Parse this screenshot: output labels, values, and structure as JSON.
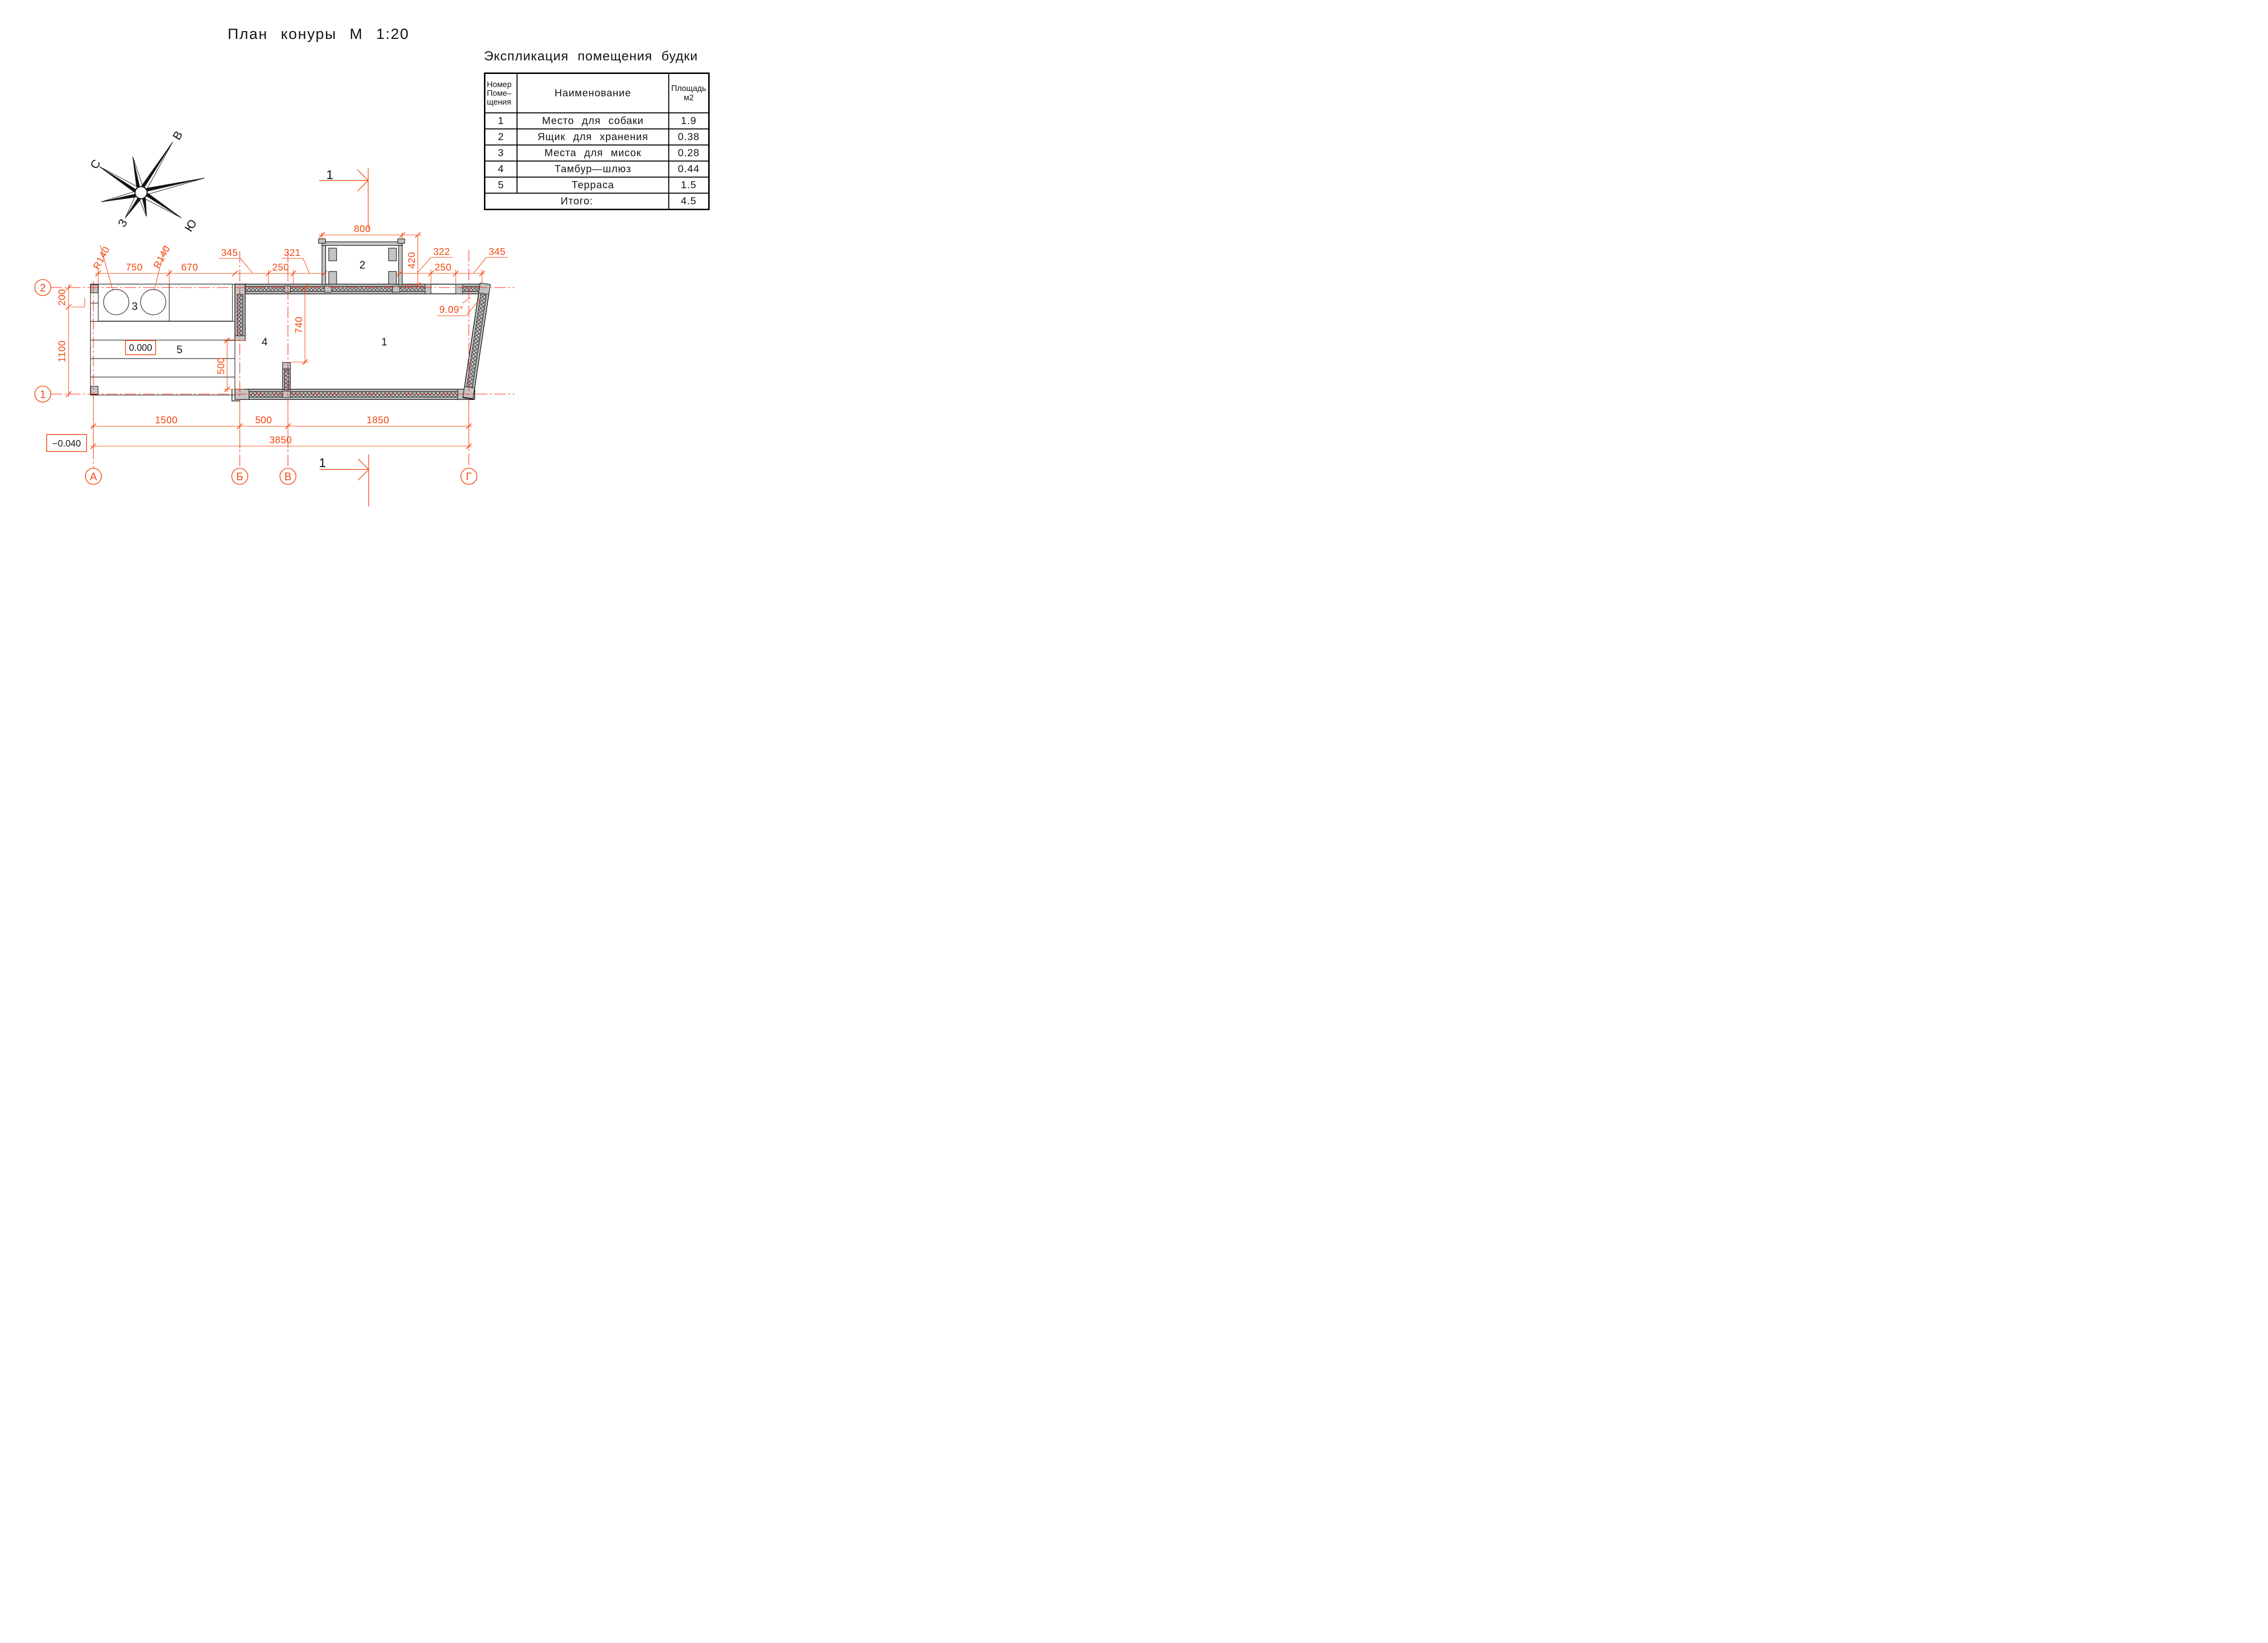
{
  "page_title": "План конуры М 1:20",
  "explication": {
    "title": "Экспликация помещения будки",
    "col_headers": {
      "number": [
        "Номер",
        "Поме–",
        "щения"
      ],
      "name": "Наименование",
      "area": [
        "Площадь",
        "м2"
      ]
    },
    "rows": [
      {
        "num": "1",
        "name": "Место для собаки",
        "area": "1.9"
      },
      {
        "num": "2",
        "name": "Ящик для хранения",
        "area": "0.38"
      },
      {
        "num": "3",
        "name": "Места для мисок",
        "area": "0.28"
      },
      {
        "num": "4",
        "name": "Тамбур—шлюз",
        "area": "0.44"
      },
      {
        "num": "5",
        "name": "Терраса",
        "area": "1.5"
      }
    ],
    "total_label": "Итого:",
    "total_value": "4.5"
  },
  "compass": {
    "north": "С",
    "east": "В",
    "west": "З",
    "south": "Ю"
  },
  "plan": {
    "rooms": {
      "r1": "1",
      "r2": "2",
      "r3": "3",
      "r4": "4",
      "r5": "5"
    },
    "axes": {
      "a": "А",
      "b": "Б",
      "v": "В",
      "g": "Г",
      "h1": "1",
      "h2": "2"
    },
    "section": {
      "label": "1"
    },
    "levels": {
      "zero": "0.000",
      "minus": "−0.040"
    },
    "angle": "9.09°",
    "dims": {
      "d800": "800",
      "d420": "420",
      "d345l": "345",
      "d321": "321",
      "d322": "322",
      "d345r": "345",
      "d250l": "250",
      "d250r": "250",
      "d750": "750",
      "d670": "670",
      "r140a": "R140",
      "r140b": "R140",
      "d200": "200",
      "d1100": "1100",
      "d500door": "500",
      "d740": "740",
      "d1500": "1500",
      "d500": "500",
      "d1850": "1850",
      "d3850": "3850"
    }
  },
  "colors": {
    "dim_orange": "#f4470e",
    "axis_red": "#ff1803",
    "wall_gray": "#c4c4c4"
  }
}
